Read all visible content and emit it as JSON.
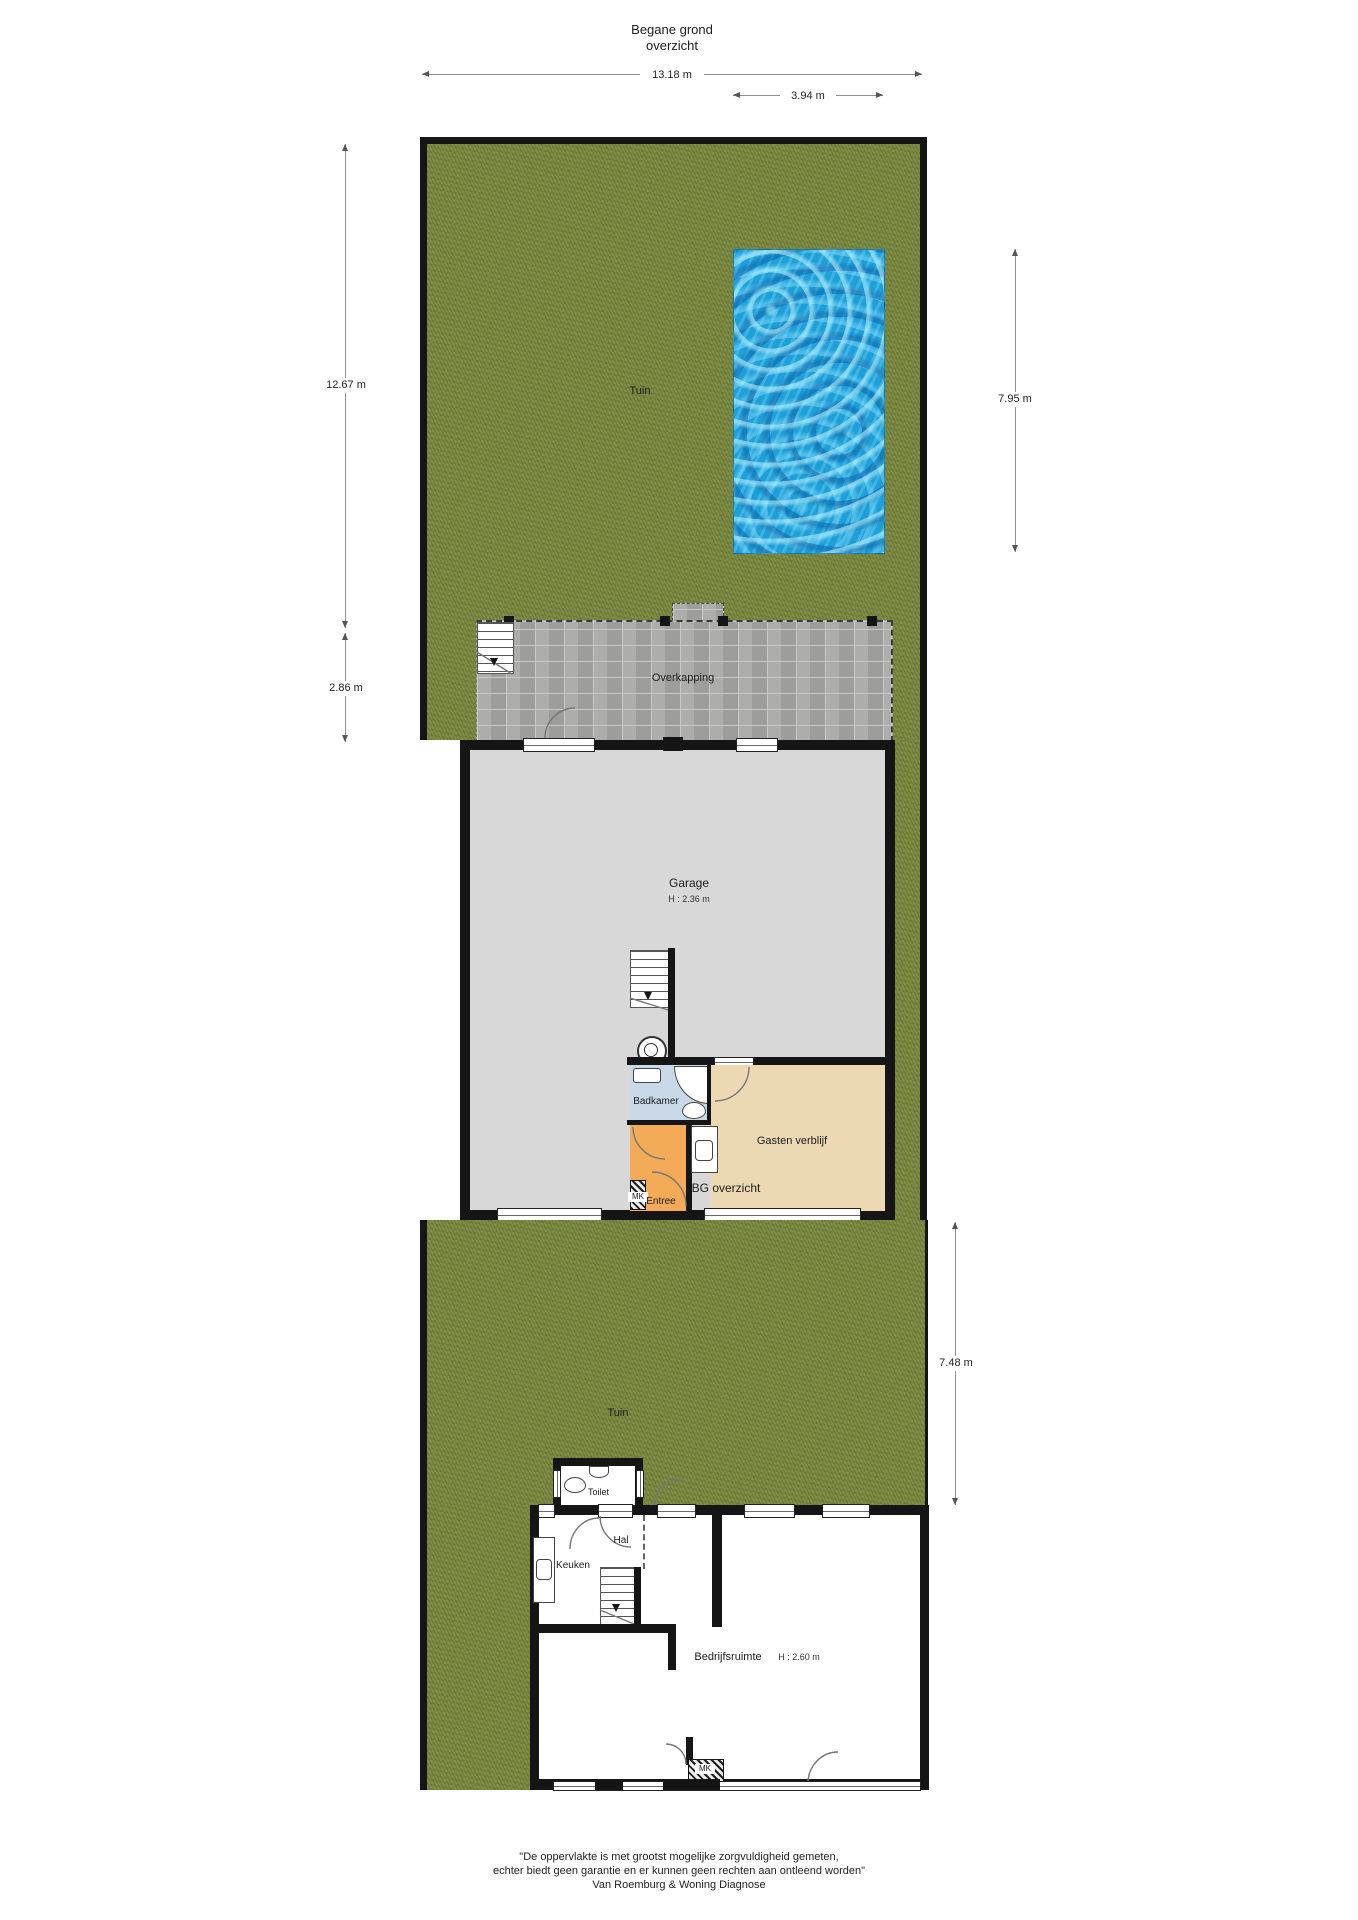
{
  "title": {
    "line1": "Begane grond",
    "line2": "overzicht"
  },
  "dimensions": {
    "plot_width": "13.18 m",
    "pool_width": "3.94 m",
    "garden_top_height": "12.67 m",
    "overkapping_height": "2.86 m",
    "pool_height": "7.95 m",
    "garden_bottom_height": "7.48 m"
  },
  "rooms": {
    "garden_top": "Tuin",
    "garden_bottom": "Tuin",
    "overkapping": "Overkapping",
    "garage": {
      "name": "Garage",
      "ceiling_height": "H : 2.36 m"
    },
    "badkamer": "Badkamer",
    "gasten_verblijf": "Gasten verblijf",
    "entree": "Entree",
    "meterkast_entree": "MK",
    "bg_overzicht": "BG overzicht",
    "toilet": "Toilet",
    "hal": "Hal",
    "keuken": "Keuken",
    "bedrijfsruimte": {
      "name": "Bedrijfsruimte",
      "ceiling_height": "H : 2.60 m"
    },
    "meterkast_bedrijfsruimte": "MK"
  },
  "footer": {
    "line1": "\"De oppervlakte is met grootst mogelijke zorgvuldigheid gemeten,",
    "line2": "echter biedt geen garantie en er kunnen geen rechten aan ontleend worden\"",
    "line3": "Van Roemburg & Woning Diagnose"
  },
  "colors": {
    "grass": "#7e8c44",
    "pool_water": "#1e9fd8",
    "paving": "#a7a7a5",
    "wall": "#151515",
    "garage_floor": "#d8d8d8",
    "badkamer_floor": "#c9d9e8",
    "gasten_floor": "#ecd9b4",
    "entree_floor": "#f3ab57"
  }
}
